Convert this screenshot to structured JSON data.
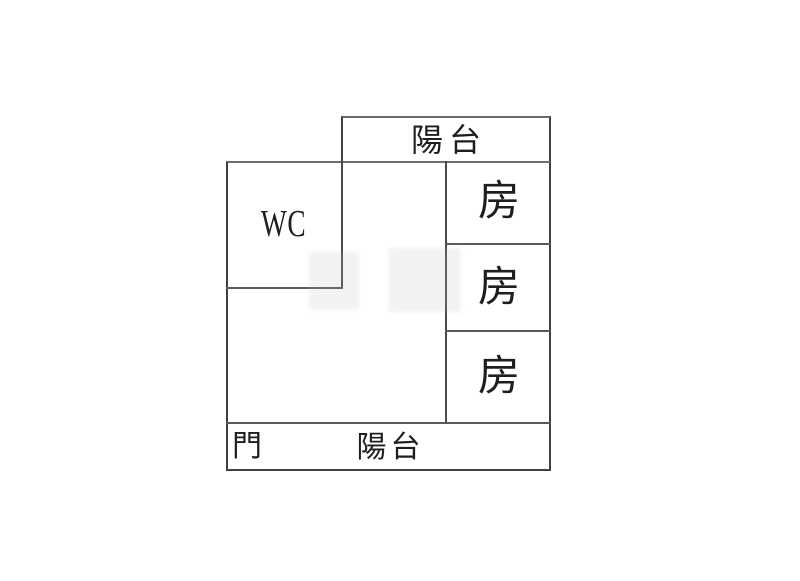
{
  "plan": {
    "top_balcony": {
      "label": "陽台"
    },
    "wc_room": {
      "label": "WC"
    },
    "rooms": [
      {
        "label": "房"
      },
      {
        "label": "房"
      },
      {
        "label": "房"
      }
    ],
    "bottom_balcony": {
      "door_label": "門",
      "label": "陽台"
    }
  },
  "colors": {
    "wall": "#3f3f3f",
    "text": "#1e1e1e",
    "background": "#ffffff"
  }
}
